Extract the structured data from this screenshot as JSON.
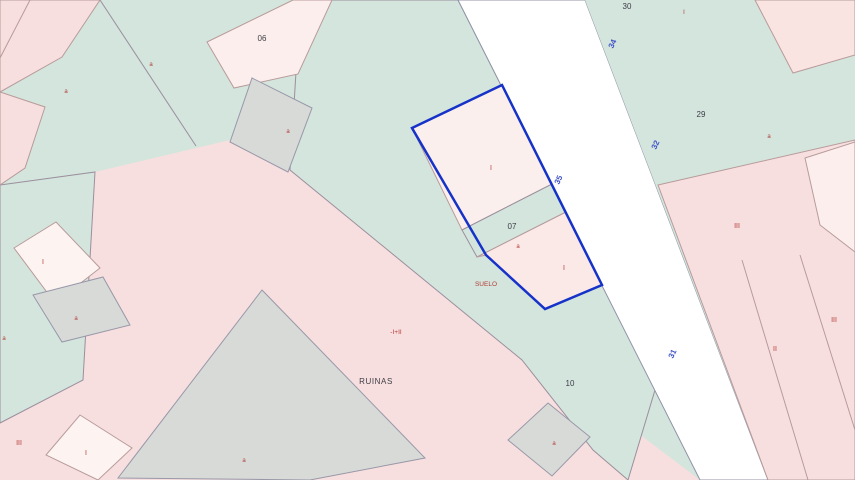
{
  "colors": {
    "parcel_green": "#d3e5dc",
    "parcel_pink": "#f8dfdf",
    "parcel_pale_pink": "#fceeec",
    "parcel_gray": "#d8dad8",
    "road_white": "#ffffff",
    "selected_outline_blue": "#1632c8",
    "street_number_blue": "#4053c8",
    "subparcel_red": "#b23b36",
    "parcel_number_dark": "#3c3c46"
  },
  "parcel_numbers": {
    "p06": "06",
    "p07": "07",
    "p10": "10",
    "p29": "29",
    "p30": "30"
  },
  "street_numbers": {
    "n34": "34",
    "n32": "32",
    "n35": "35",
    "n31": "31"
  },
  "annotations": {
    "ruins": "RUINAS",
    "ground": "SUELO",
    "height_mixed": "-I+II"
  },
  "subparcel_codes": [
    "a",
    "a",
    "a",
    "I",
    "a",
    "I",
    "I",
    "a",
    "III",
    "III",
    "II",
    "I",
    "a",
    "a",
    "III",
    "I",
    "a",
    "a"
  ]
}
